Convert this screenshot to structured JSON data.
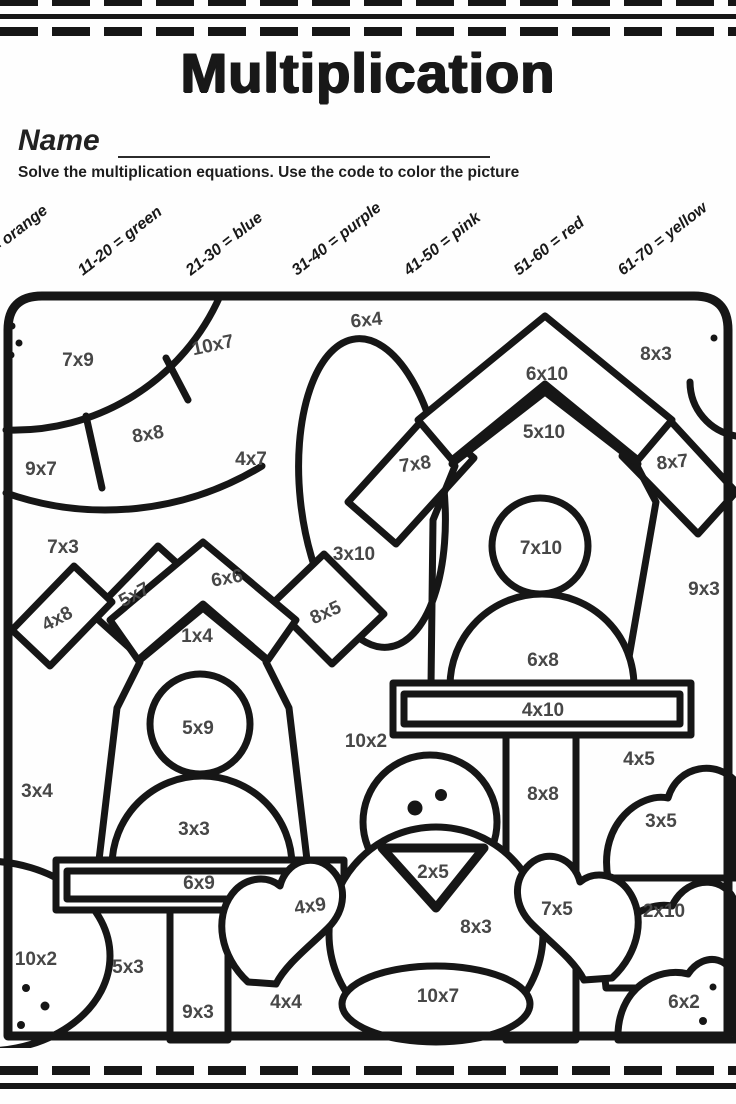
{
  "header": {
    "title": "Multiplication",
    "name_label": "Name",
    "instructions": "Solve the multiplication equations.  Use the code to color the picture"
  },
  "color_codes": [
    {
      "range": "1-10",
      "color": "orange",
      "label": "1-10 = orange"
    },
    {
      "range": "11-20",
      "color": "green",
      "label": "11-20 = green"
    },
    {
      "range": "21-30",
      "color": "blue",
      "label": "21-30 = blue"
    },
    {
      "range": "31-40",
      "color": "purple",
      "label": "31-40 = purple"
    },
    {
      "range": "41-50",
      "color": "pink",
      "label": "41-50 = pink"
    },
    {
      "range": "51-60",
      "color": "red",
      "label": "51-60 = red"
    },
    {
      "range": "61-70",
      "color": "yellow",
      "label": "61-70 = yellow"
    }
  ],
  "equations": [
    {
      "label": "7x9"
    },
    {
      "label": "10x7"
    },
    {
      "label": "6x4"
    },
    {
      "label": "8x3"
    },
    {
      "label": "6x10"
    },
    {
      "label": "8x8"
    },
    {
      "label": "4x7"
    },
    {
      "label": "7x8"
    },
    {
      "label": "9x7"
    },
    {
      "label": "5x10"
    },
    {
      "label": "8x7"
    },
    {
      "label": "7x3"
    },
    {
      "label": "6x6"
    },
    {
      "label": "3x10"
    },
    {
      "label": "5x7"
    },
    {
      "label": "7x10"
    },
    {
      "label": "9x3"
    },
    {
      "label": "4x8"
    },
    {
      "label": "1x4"
    },
    {
      "label": "8x5"
    },
    {
      "label": "6x8"
    },
    {
      "label": "4x10"
    },
    {
      "label": "5x9"
    },
    {
      "label": "10x2"
    },
    {
      "label": "4x5"
    },
    {
      "label": "3x4"
    },
    {
      "label": "8x8"
    },
    {
      "label": "3x3"
    },
    {
      "label": "3x5"
    },
    {
      "label": "2x5"
    },
    {
      "label": "6x9"
    },
    {
      "label": "4x9"
    },
    {
      "label": "7x5"
    },
    {
      "label": "2x10"
    },
    {
      "label": "8x3"
    },
    {
      "label": "10x2"
    },
    {
      "label": "5x3"
    },
    {
      "label": "10x7"
    },
    {
      "label": "4x4"
    },
    {
      "label": "9x3"
    },
    {
      "label": "6x2"
    }
  ],
  "colors": {
    "ink": "#161616",
    "equation_text": "#474747",
    "paper": "#fefefe"
  }
}
